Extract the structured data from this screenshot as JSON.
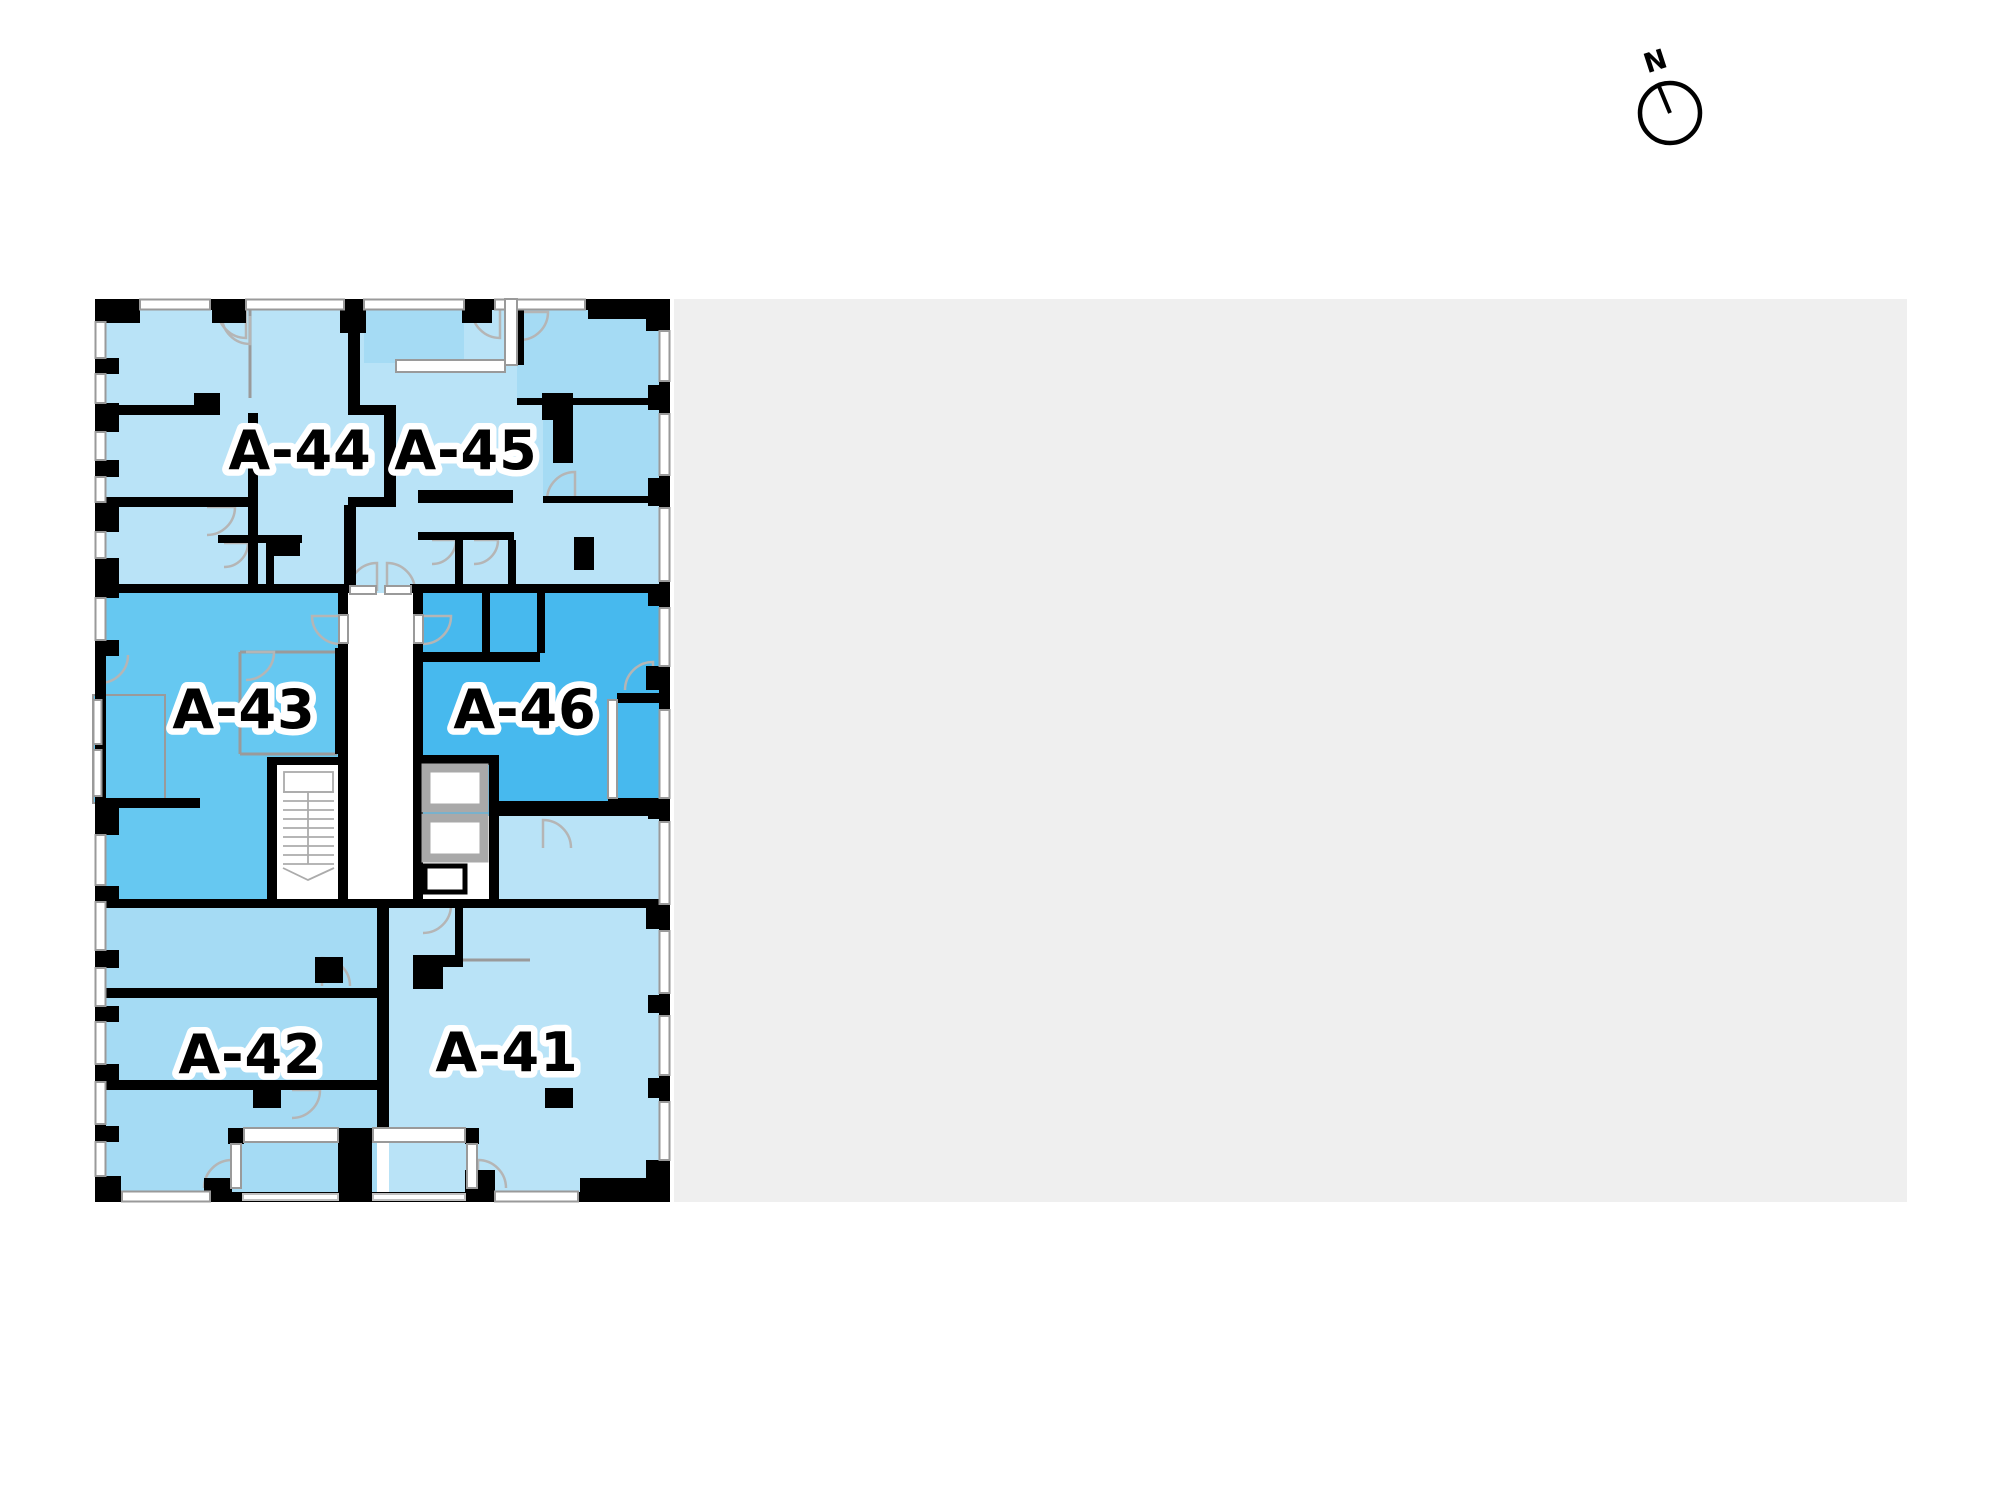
{
  "compass": {
    "label": "N"
  },
  "theme": {
    "site_gray": "#efefef",
    "wall": "#000000",
    "window_frame": "#9a9a9a",
    "door_arc": "#b5b5b5",
    "elevator_gray": "#a9a9a9",
    "unit_light": "#b9e3f7",
    "unit_light_alt": "#a5dbf4",
    "unit_43_blue": "#66c8f1",
    "unit_46_blue": "#47b9ee"
  },
  "plan": {
    "units": [
      {
        "id": "a41",
        "label": "A-41",
        "color": "#b9e3f7"
      },
      {
        "id": "a42",
        "label": "A-42",
        "color": "#a5dbf4"
      },
      {
        "id": "a43",
        "label": "A-43",
        "color": "#66c8f1"
      },
      {
        "id": "a44",
        "label": "A-44",
        "color": "#b9e3f7"
      },
      {
        "id": "a45",
        "label": "A-45",
        "color": "#b9e3f7"
      },
      {
        "id": "a46",
        "label": "A-46",
        "color": "#47b9ee"
      }
    ]
  }
}
